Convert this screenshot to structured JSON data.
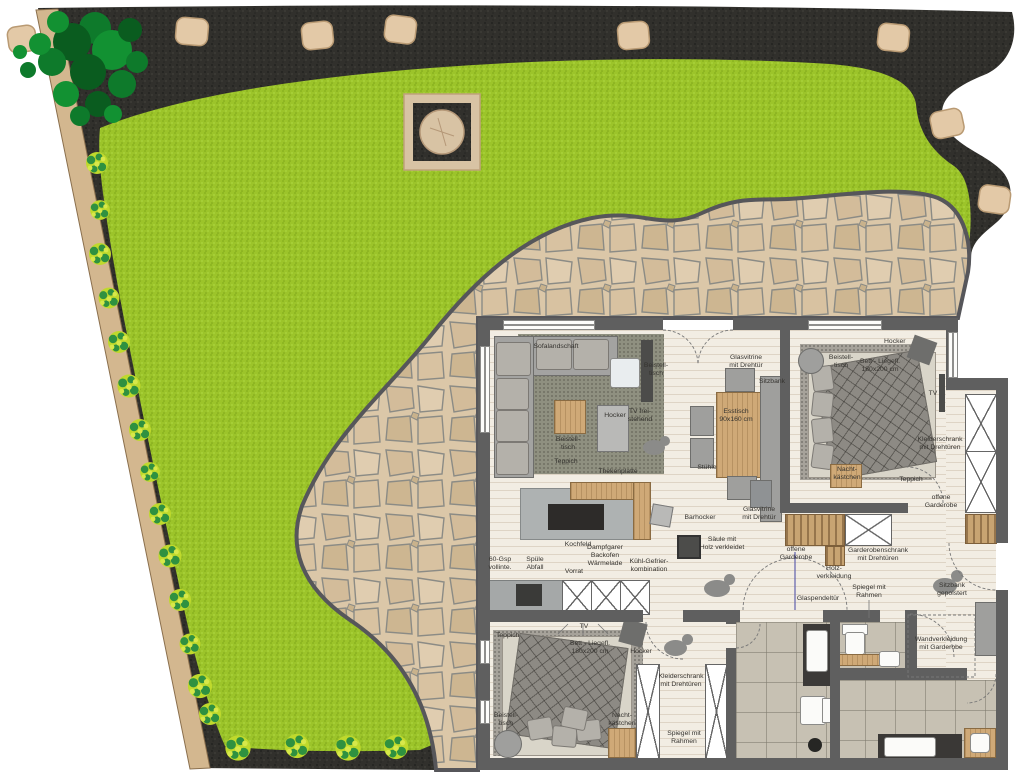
{
  "colors": {
    "lawn": "#9cc42a",
    "soil": "#31302c",
    "stone_path": "#dbc7a8",
    "tan_wall": "#d3b78f",
    "house_wall": "#5f5f5f",
    "wood_floor": "#f2ede3",
    "tree_green": "#0e7a2b",
    "bush_green": "#bfd92c"
  },
  "labels": {
    "living": {
      "sofa": "Sofalandschaft",
      "side_table_white": "Beistell-\ntisch",
      "tv": "TV frei-\nstehend",
      "stool": "Hocker",
      "side_table_wood": "Beistell-\ntisch",
      "rug": "Teppich"
    },
    "kitchen": {
      "counter_top": "Thekenplatte",
      "cooktop": "Kochfeld",
      "bar_stool": "Barhocker",
      "dishwasher": "60-Gsp\nvollinte.",
      "sink": "Spüle\nAbfall",
      "pantry": "Vorrat",
      "oven": "Dampfgarer\nBackofen\nWärmelade",
      "fridge": "Kühl-Gefrier-\nkombination"
    },
    "dining": {
      "vitrine_top": "Glasvitrine\nmit Drehtür",
      "table": "Esstisch\n90x160 cm",
      "chairs": "Stühle",
      "bench": "Sitzbank",
      "vitrine_lower": "Glasvitrine\nmit Drehtür"
    },
    "bedroom1": {
      "side_table": "Beistell-\ntisch",
      "bed": "Bett - Liegefl.\n180x200 cm",
      "stool": "Hocker",
      "tv": "TV",
      "wardrobe": "Kleiderschrank\nmit Drehtüren",
      "nightstand": "Nacht-\nkästchen",
      "rug": "Teppich",
      "open_closet": "offene\nGarderobe"
    },
    "hall": {
      "column": "Säule mit\nHolz verkleidet",
      "open_closet": "offene\nGarderobe",
      "wood_panel": "Holz-\nverkleidung",
      "closet": "Garderobenschrank\nmit Drehtüren",
      "glass_door": "Glaspendeltür",
      "mirror": "Spiegel mit\nRahmen",
      "bench": "Sitzbank\ngepolstert",
      "wall_cladding": "Wandverkleidung\nmit Garderobe"
    },
    "bedroom2": {
      "tv": "TV",
      "rug": "Teppich",
      "bed": "Bett - Liegefl.\n180x200 cm",
      "stool": "Hocker",
      "wardrobe": "Kleiderschrank\nmit Drehtüren",
      "side_table": "Beistell-\ntisch",
      "nightstand": "Nacht-\nkästchen",
      "mirror": "Spiegel mit\nRahmen"
    }
  }
}
